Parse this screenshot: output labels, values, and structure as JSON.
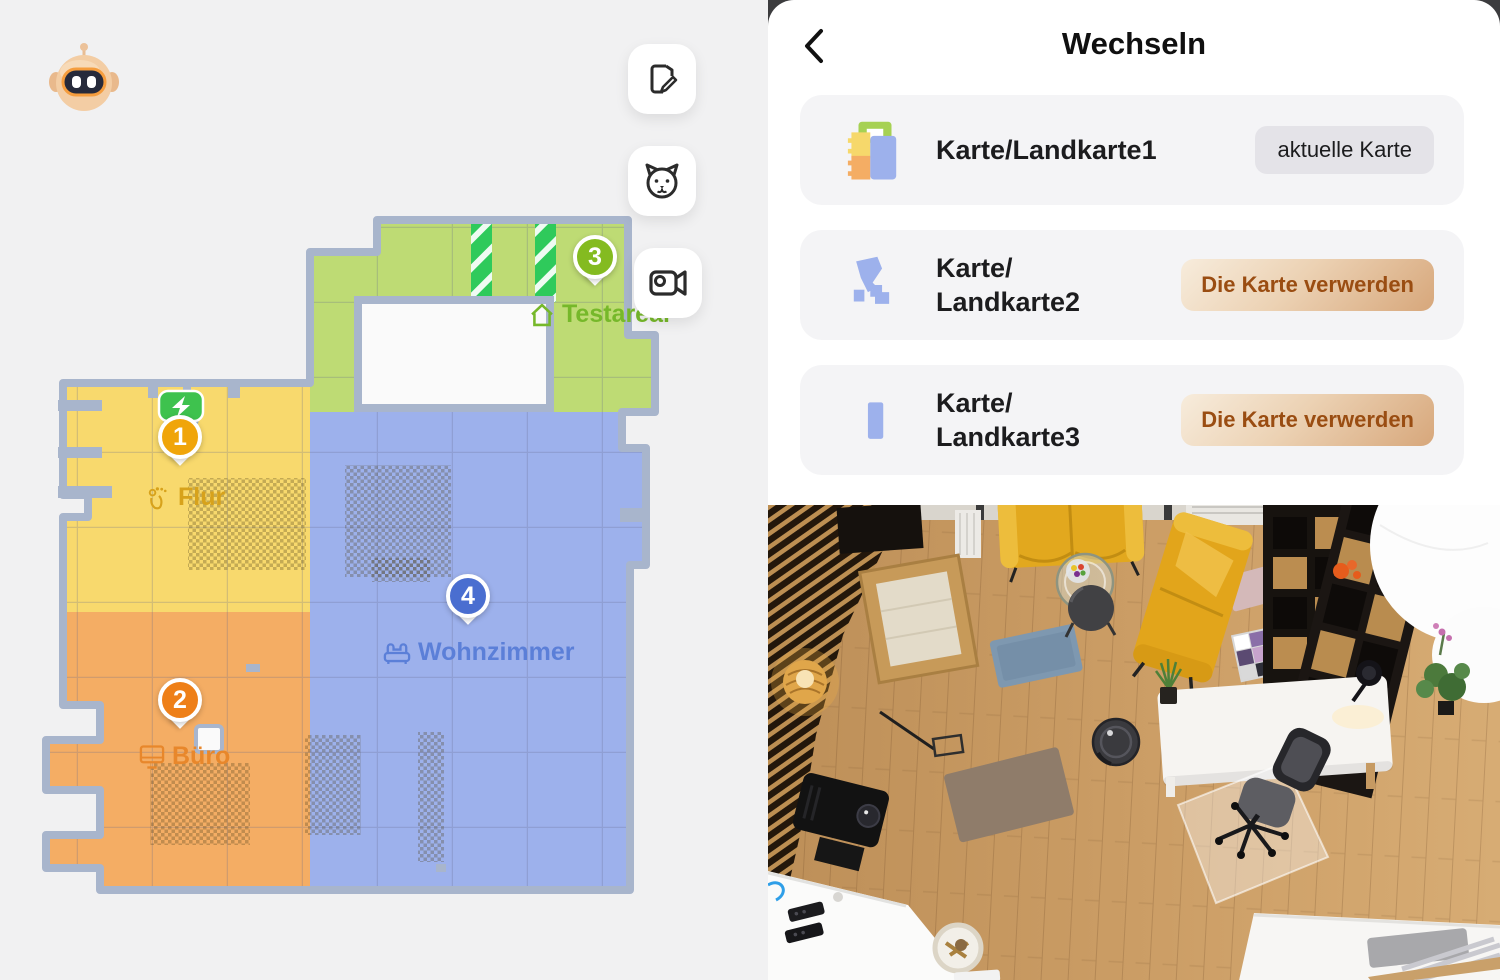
{
  "left_panel": {
    "robot_avatar": {
      "icon": "robot-mascot-icon"
    },
    "toolbar": {
      "buttons": [
        {
          "icon": "edit-map-icon"
        },
        {
          "icon": "pet-face-icon"
        },
        {
          "icon": "video-camera-icon"
        }
      ]
    },
    "map": {
      "wall_color": "#a8b5cc",
      "dock": {
        "icon": "charging-dock-icon",
        "color": "#3ec24e"
      },
      "rooms": [
        {
          "number": "1",
          "name": "Flur",
          "icon": "footprints-icon",
          "fill": "#f8d96d",
          "label_color": "#d7a21b",
          "marker_color": "#f0a50a"
        },
        {
          "number": "2",
          "name": "Büro",
          "icon": "monitor-icon",
          "fill": "#f4ad64",
          "label_color": "#e8872b",
          "marker_color": "#ee7f18"
        },
        {
          "number": "3",
          "name": "Testareal",
          "icon": "home-icon",
          "fill": "#bedb74",
          "label_color": "#76b82a",
          "marker_color": "#84bb20"
        },
        {
          "number": "4",
          "name": "Wohnzimmer",
          "icon": "sofa-icon",
          "fill": "#9db1ec",
          "label_color": "#5b7fd8",
          "marker_color": "#4a6ed0"
        }
      ]
    }
  },
  "right_panel": {
    "header": {
      "back_icon": "chevron-left-icon",
      "title": "Wechseln"
    },
    "maps": [
      {
        "thumb": "map1-thumbnail",
        "name": "Karte/Landkarte1",
        "name_lines": [
          "Karte/Landkarte1",
          ""
        ],
        "badge": "aktuelle Karte"
      },
      {
        "thumb": "map2-thumbnail",
        "name": "Karte/Landkarte2",
        "name_lines": [
          "Karte/",
          "Landkarte2"
        ],
        "action": "Die Karte verwerden"
      },
      {
        "thumb": "map3-thumbnail",
        "name": "Karte/Landkarte3",
        "name_lines": [
          "Karte/",
          "Landkarte3"
        ],
        "action": "Die Karte verwerden"
      }
    ],
    "action_button_colors": {
      "gradient_start": "#f6e9d8",
      "gradient_end": "#d7a77b",
      "text": "#9a4d12"
    }
  }
}
